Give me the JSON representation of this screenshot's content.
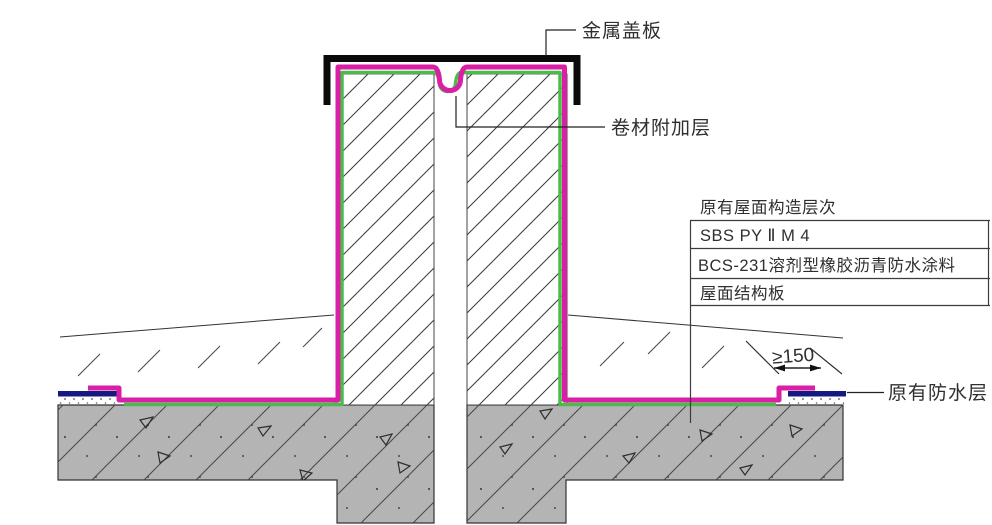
{
  "diagram": {
    "labels": {
      "metal_cover": "金属盖板",
      "membrane_patch": "卷材附加层",
      "existing_waterproofing": "原有防水层",
      "dimension_min_overlap": "≥150"
    },
    "layer_table": {
      "title": "原有屋面构造层次",
      "rows": [
        "SBS PY Ⅱ M 4",
        "BCS-231溶剂型橡胶沥青防水涂料",
        "屋面结构板"
      ]
    },
    "colors": {
      "membrane": "#d81fa5",
      "membrane_inner": "#4bbc4b",
      "existing_membrane": "#161a7e",
      "slab_fill": "#b4b4b4",
      "cover_plate": "#0a0a0a",
      "line": "#333333"
    }
  }
}
